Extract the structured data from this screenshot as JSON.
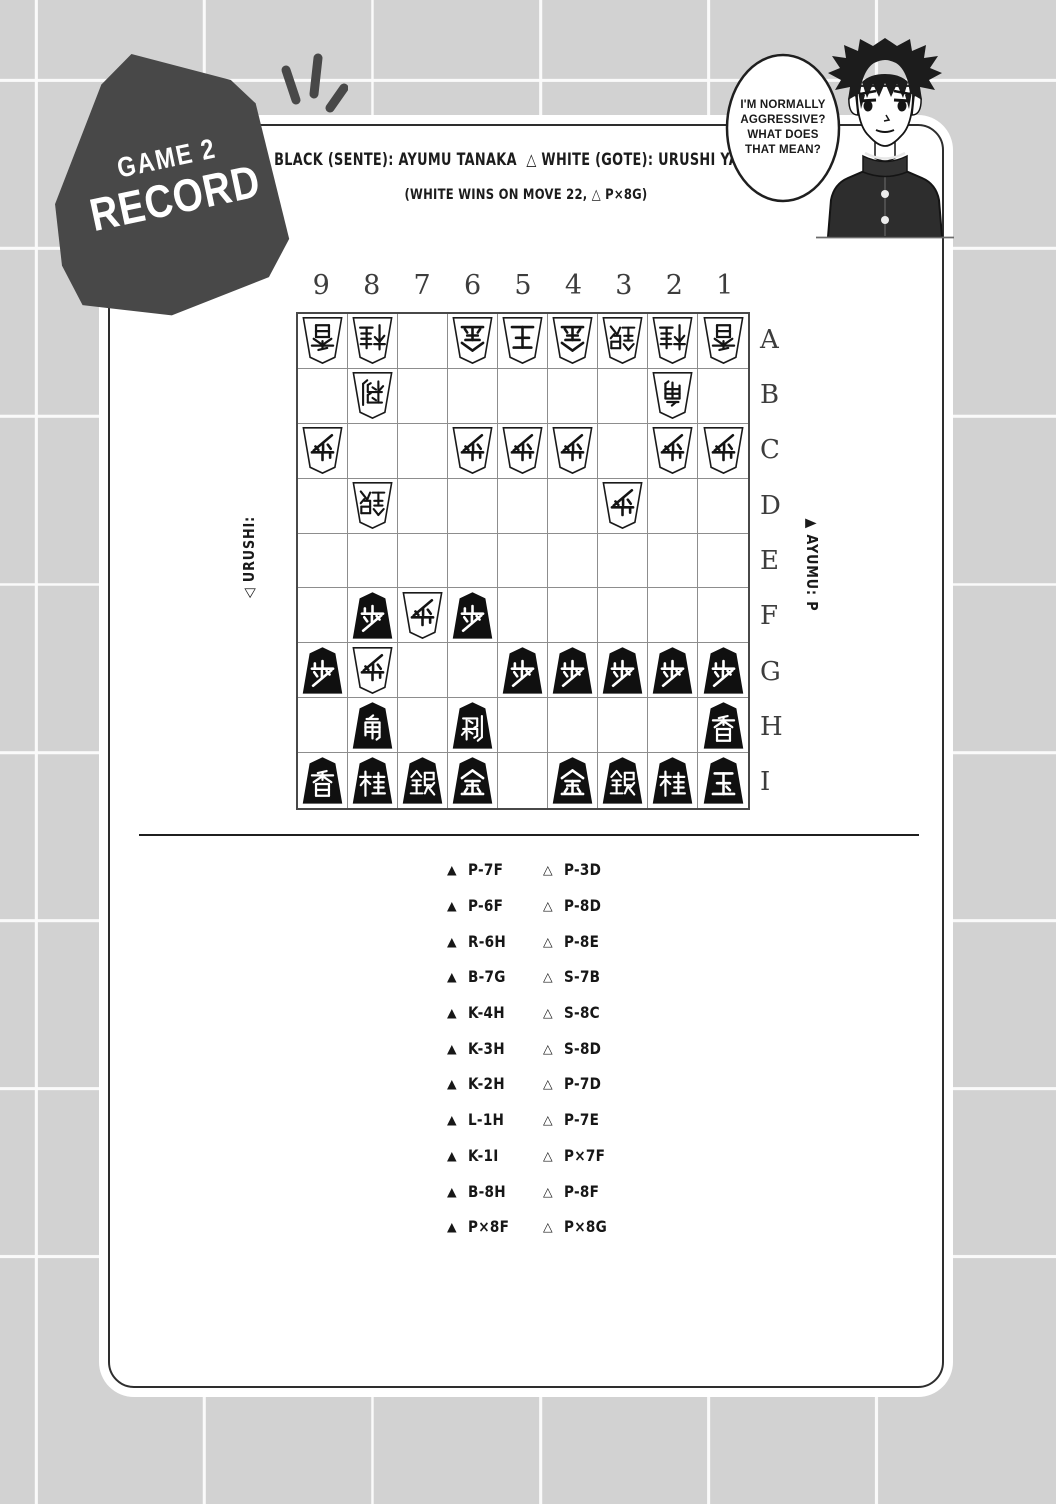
{
  "page": {
    "background": "#d2d2d2",
    "grid_line": "#fafafa",
    "panel_bg": "#ffffff"
  },
  "badge": {
    "line1": "GAME 2",
    "line2": "RECORD",
    "color": "#484848"
  },
  "header": {
    "title": "▲ BLACK (SENTE): AYUMU TANAKA  △ WHITE (GOTE): URUSHI YAOTOME",
    "subtitle": "(WHITE WINS ON MOVE 22, △ P×8G)"
  },
  "speech_bubble": {
    "text": "I'M NORMALLY AGGRESSIVE? WHAT DOES THAT MEAN?"
  },
  "board": {
    "column_labels": [
      "9",
      "8",
      "7",
      "6",
      "5",
      "4",
      "3",
      "2",
      "1"
    ],
    "row_labels": [
      "A",
      "B",
      "C",
      "D",
      "E",
      "F",
      "G",
      "H",
      "I"
    ],
    "left_hand_label": "◁ URUSHI:",
    "right_hand_label": "▲ AYUMU: P",
    "pieces": [
      {
        "square": "9A",
        "side": "gote",
        "piece": "lance",
        "kanji": "香"
      },
      {
        "square": "8A",
        "side": "gote",
        "piece": "knight",
        "kanji": "桂"
      },
      {
        "square": "6A",
        "side": "gote",
        "piece": "gold",
        "kanji": "金"
      },
      {
        "square": "5A",
        "side": "gote",
        "piece": "king",
        "kanji": "王"
      },
      {
        "square": "4A",
        "side": "gote",
        "piece": "gold",
        "kanji": "金"
      },
      {
        "square": "3A",
        "side": "gote",
        "piece": "silver",
        "kanji": "銀"
      },
      {
        "square": "2A",
        "side": "gote",
        "piece": "knight",
        "kanji": "桂"
      },
      {
        "square": "1A",
        "side": "gote",
        "piece": "lance",
        "kanji": "香"
      },
      {
        "square": "8B",
        "side": "gote",
        "piece": "rook",
        "kanji": "飛"
      },
      {
        "square": "2B",
        "side": "gote",
        "piece": "bishop",
        "kanji": "角"
      },
      {
        "square": "9C",
        "side": "gote",
        "piece": "pawn",
        "kanji": "歩"
      },
      {
        "square": "6C",
        "side": "gote",
        "piece": "pawn",
        "kanji": "歩"
      },
      {
        "square": "5C",
        "side": "gote",
        "piece": "pawn",
        "kanji": "歩"
      },
      {
        "square": "4C",
        "side": "gote",
        "piece": "pawn",
        "kanji": "歩"
      },
      {
        "square": "2C",
        "side": "gote",
        "piece": "pawn",
        "kanji": "歩"
      },
      {
        "square": "1C",
        "side": "gote",
        "piece": "pawn",
        "kanji": "歩"
      },
      {
        "square": "8D",
        "side": "gote",
        "piece": "silver",
        "kanji": "銀"
      },
      {
        "square": "3D",
        "side": "gote",
        "piece": "pawn",
        "kanji": "歩"
      },
      {
        "square": "8F",
        "side": "sente",
        "piece": "pawn",
        "kanji": "歩"
      },
      {
        "square": "7F",
        "side": "gote",
        "piece": "pawn",
        "kanji": "歩"
      },
      {
        "square": "6F",
        "side": "sente",
        "piece": "pawn",
        "kanji": "歩"
      },
      {
        "square": "9G",
        "side": "sente",
        "piece": "pawn",
        "kanji": "歩"
      },
      {
        "square": "8G",
        "side": "gote",
        "piece": "pawn",
        "kanji": "歩"
      },
      {
        "square": "5G",
        "side": "sente",
        "piece": "pawn",
        "kanji": "歩"
      },
      {
        "square": "4G",
        "side": "sente",
        "piece": "pawn",
        "kanji": "歩"
      },
      {
        "square": "3G",
        "side": "sente",
        "piece": "pawn",
        "kanji": "歩"
      },
      {
        "square": "2G",
        "side": "sente",
        "piece": "pawn",
        "kanji": "歩"
      },
      {
        "square": "1G",
        "side": "sente",
        "piece": "pawn",
        "kanji": "歩"
      },
      {
        "square": "8H",
        "side": "sente",
        "piece": "bishop",
        "kanji": "角"
      },
      {
        "square": "6H",
        "side": "sente",
        "piece": "rook",
        "kanji": "飛"
      },
      {
        "square": "1H",
        "side": "sente",
        "piece": "lance",
        "kanji": "香"
      },
      {
        "square": "9I",
        "side": "sente",
        "piece": "lance",
        "kanji": "香"
      },
      {
        "square": "8I",
        "side": "sente",
        "piece": "knight",
        "kanji": "桂"
      },
      {
        "square": "7I",
        "side": "sente",
        "piece": "silver",
        "kanji": "銀"
      },
      {
        "square": "6I",
        "side": "sente",
        "piece": "gold",
        "kanji": "金"
      },
      {
        "square": "4I",
        "side": "sente",
        "piece": "gold",
        "kanji": "金"
      },
      {
        "square": "3I",
        "side": "sente",
        "piece": "silver",
        "kanji": "銀"
      },
      {
        "square": "2I",
        "side": "sente",
        "piece": "knight",
        "kanji": "桂"
      },
      {
        "square": "1I",
        "side": "sente",
        "piece": "king",
        "kanji": "玉"
      }
    ]
  },
  "moves": {
    "black_mark": "▲",
    "white_mark": "△",
    "rows": [
      {
        "black": "P-7F",
        "white": "P-3D"
      },
      {
        "black": "P-6F",
        "white": "P-8D"
      },
      {
        "black": "R-6H",
        "white": "P-8E"
      },
      {
        "black": "B-7G",
        "white": "S-7B"
      },
      {
        "black": "K-4H",
        "white": "S-8C"
      },
      {
        "black": "K-3H",
        "white": "S-8D"
      },
      {
        "black": "K-2H",
        "white": "P-7D"
      },
      {
        "black": "L-1H",
        "white": "P-7E"
      },
      {
        "black": "K-1I",
        "white": "P×7F"
      },
      {
        "black": "B-8H",
        "white": "P-8F"
      },
      {
        "black": "P×8F",
        "white": "P×8G"
      }
    ]
  }
}
